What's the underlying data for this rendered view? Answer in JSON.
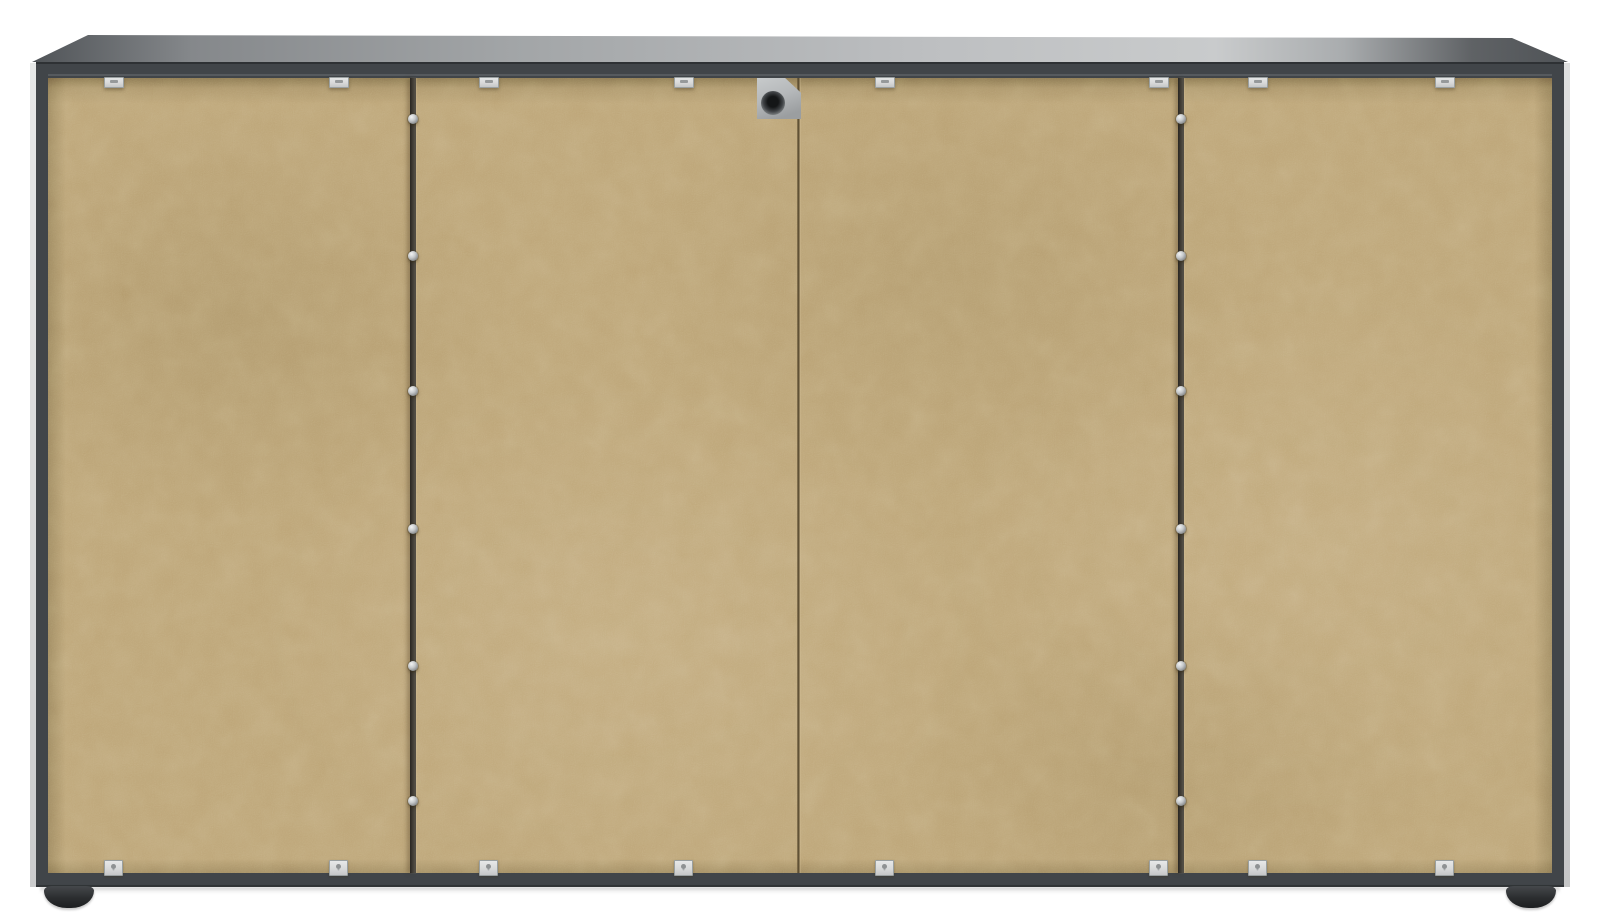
{
  "scene": {
    "description": "rear-view-of-sideboard-cabinet",
    "background_color": "#ffffff"
  },
  "cabinet": {
    "colors": {
      "frame": "#414549",
      "panel": "#bda577",
      "side_highlight": "#dcdddd",
      "divider": "#3e3a33",
      "seam": "#57492f",
      "staple": "#d8d9d9",
      "screw": "#c6c9cb",
      "bracket": "#b5b8ba",
      "foot": "#2b2d2f"
    },
    "top_gradient": [
      {
        "color": "#45494d",
        "pos": "0%"
      },
      {
        "color": "#85888b",
        "pos": "12%"
      },
      {
        "color": "#a2a5a7",
        "pos": "32%"
      },
      {
        "color": "#bdbfc1",
        "pos": "58%"
      },
      {
        "color": "#c9cbcc",
        "pos": "76%"
      },
      {
        "color": "#a9acae",
        "pos": "84%"
      },
      {
        "color": "#5f6265",
        "pos": "92%"
      },
      {
        "color": "#4a4e52",
        "pos": "100%"
      }
    ],
    "dividers": {
      "x_left": [
        410,
        1178
      ],
      "width": 6
    },
    "seam": {
      "x": 797,
      "width": 4
    },
    "staples": {
      "top_y": 77,
      "bottom_y": 860,
      "x_centers": [
        113,
        338,
        488,
        683,
        884,
        1158,
        1257,
        1444
      ]
    },
    "screws": {
      "x_centers": [
        413,
        1181
      ],
      "y_centers": [
        119,
        256,
        391,
        529,
        666,
        801
      ]
    },
    "bracket": {
      "x": 757,
      "y": 78,
      "width": 44,
      "height": 41
    },
    "feet": {
      "x_lefts": [
        44,
        1506
      ],
      "y": 886,
      "width": 50,
      "height": 22
    }
  }
}
